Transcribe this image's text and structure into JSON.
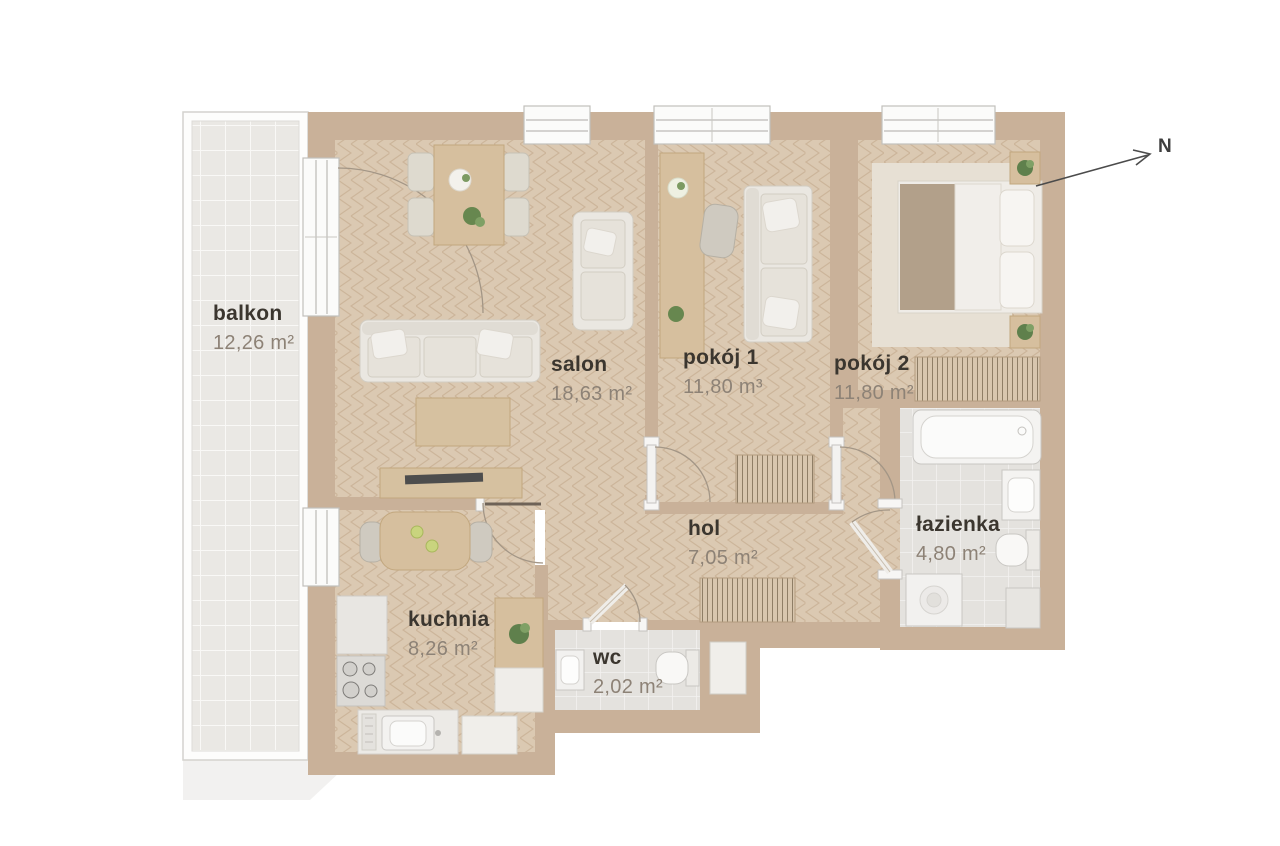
{
  "compass": {
    "label": "N"
  },
  "rooms": [
    {
      "id": "balkon",
      "name": "balkon",
      "area": "12,26 m²"
    },
    {
      "id": "salon",
      "name": "salon",
      "area": "18,63 m²"
    },
    {
      "id": "pokoj-1",
      "name": "pokój 1",
      "area": "11,80 m³"
    },
    {
      "id": "pokoj-2",
      "name": "pokój 2",
      "area": "11,80 m²"
    },
    {
      "id": "hol",
      "name": "hol",
      "area": "7,05 m²"
    },
    {
      "id": "lazienka",
      "name": "łazienka",
      "area": "4,80 m²"
    },
    {
      "id": "kuchnia",
      "name": "kuchnia",
      "area": "8,26 m²"
    },
    {
      "id": "wc",
      "name": "wc",
      "area": "2,02 m²"
    }
  ],
  "colors": {
    "wall": "#c9b199",
    "wood_floor": "#dbc9b2",
    "tile_floor": "#e4e2de",
    "balcony_floor": "#eae8e4",
    "background": "#ffffff",
    "room_name_text": "#3b362f",
    "room_area_text": "#8d8276"
  }
}
